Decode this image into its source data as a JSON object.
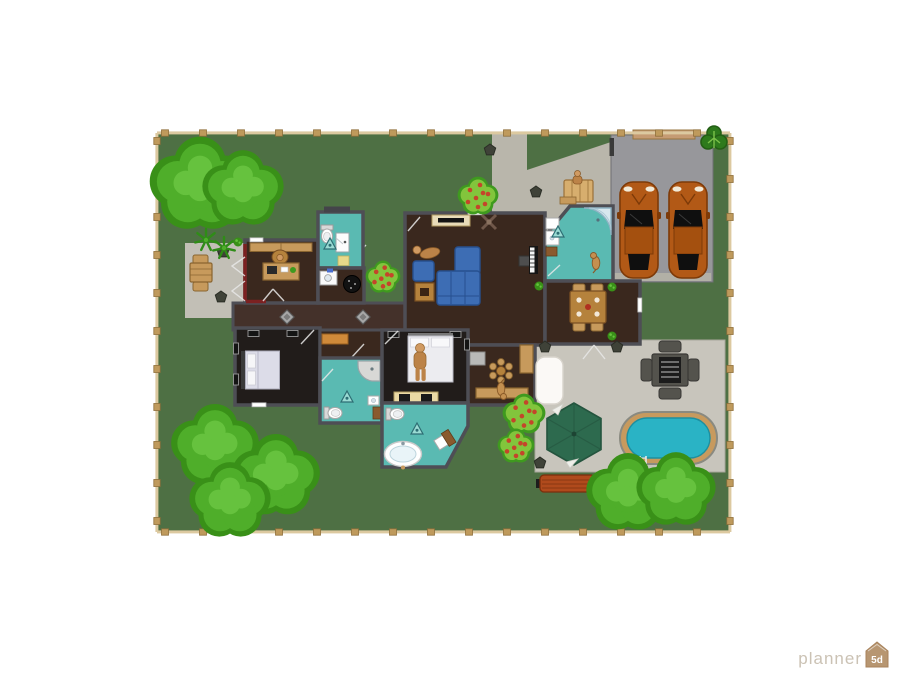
{
  "app": {
    "watermark_brand": "planner",
    "watermark_badge": "5d"
  },
  "palette": {
    "lawn": "#4e7044",
    "path": "#b9b6ab",
    "patio": "#c8c5bc",
    "patio_left": "#c2bfb6",
    "garage_pad": "#97979b",
    "garage_apron": "#b2b0a6",
    "garage_door": "#c59b73",
    "car_body": "#b25916",
    "car_roof": "#a4500f",
    "car_glass": "#0f0f0f",
    "wall": "#4e4e55",
    "wall_accent": "#7c2121",
    "floor_wood": "#3a281e",
    "floor_hall": "#44312a",
    "floor_bedroom": "#211c1a",
    "floor_teal": "#5abab2",
    "wood": "#c79a5c",
    "wood_dark": "#8a6530",
    "table_wood": "#b5823c",
    "sofa": "#3d6db4",
    "sofa_dark": "#27508f",
    "skin": "#d09a62",
    "cloth": "#bc8348",
    "pool_deck": "#c79a5e",
    "pool_water": "#2ab3c5",
    "umbrella": "#2d6a4e",
    "bench": "#b04a1c",
    "bbq": "#54534d",
    "grill": "#1c1c1c",
    "tree_dark": "#399018",
    "tree_mid": "#4fae2a",
    "tree_light": "#66c23e",
    "bush_dark": "#3f9a1f",
    "bush_mid": "#82c53c",
    "berry": "#c4452a",
    "fence_rail": "#dcc9a0",
    "fence_post": "#bf9a5c",
    "stone": "#3f4238",
    "yellow_mat": "#e8d98a",
    "appliance_gray": "#b9b9b7",
    "watermark_text": "#cbc2b4",
    "watermark_badge": "#b79671"
  },
  "scene": {
    "fence": {
      "x": 157,
      "y": 133,
      "width": 573,
      "height": 399,
      "post_spacing": 38
    },
    "trees": [
      {
        "x": 200,
        "y": 186,
        "r": 47
      },
      {
        "x": 243,
        "y": 190,
        "r": 38
      },
      {
        "x": 215,
        "y": 447,
        "r": 41
      },
      {
        "x": 276,
        "y": 477,
        "r": 41
      },
      {
        "x": 230,
        "y": 502,
        "r": 38
      },
      {
        "x": 628,
        "y": 494,
        "r": 39
      },
      {
        "x": 676,
        "y": 491,
        "r": 37
      }
    ],
    "small_tree": {
      "x": 714,
      "y": 140
    },
    "bushes": [
      {
        "x": 383,
        "y": 277,
        "r": 17
      },
      {
        "x": 478,
        "y": 196,
        "r": 20
      },
      {
        "x": 524,
        "y": 414,
        "r": 21
      },
      {
        "x": 516,
        "y": 446,
        "r": 18
      }
    ],
    "stones": [
      [
        223,
        252
      ],
      [
        221,
        297
      ],
      [
        490,
        150
      ],
      [
        536,
        192
      ],
      [
        545,
        347
      ],
      [
        617,
        347
      ],
      [
        540,
        463
      ]
    ],
    "palms": [
      [
        206,
        240
      ],
      [
        224,
        248
      ]
    ]
  }
}
